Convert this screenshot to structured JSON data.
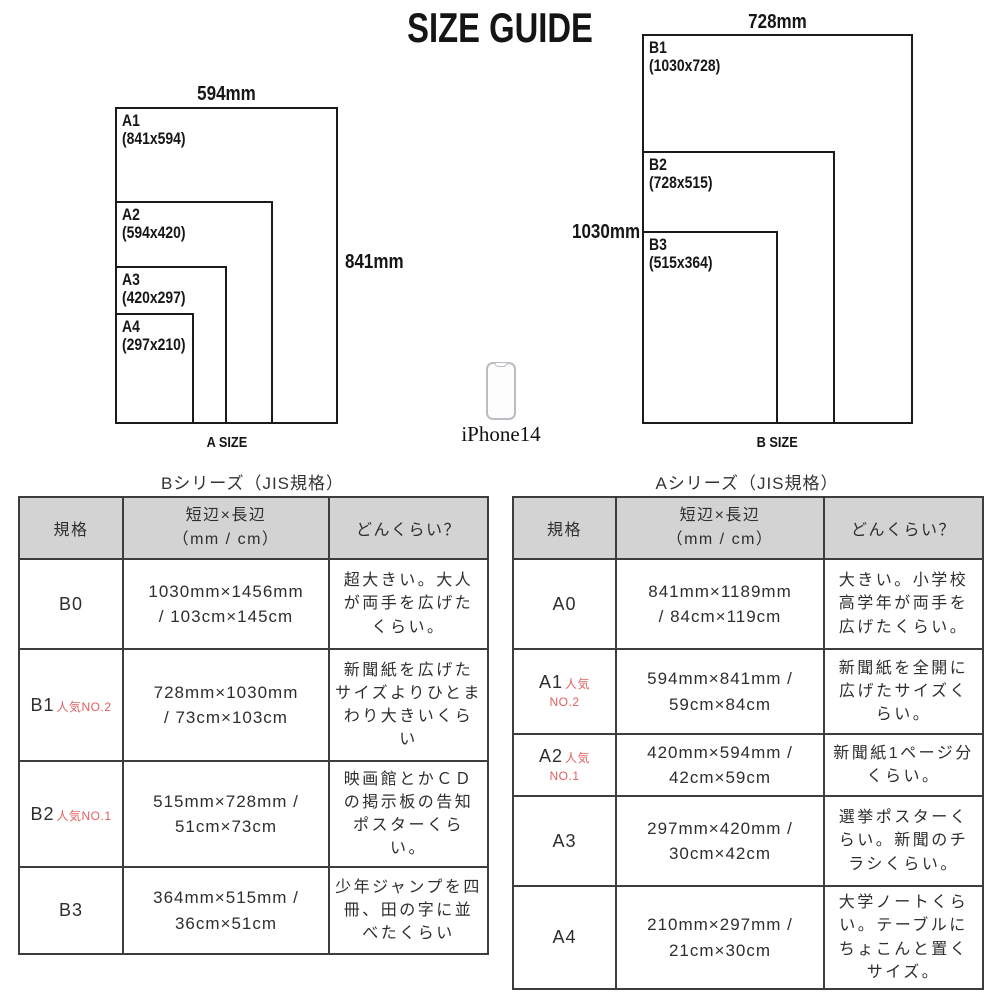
{
  "title": "SIZE GUIDE",
  "diagrams": {
    "a": {
      "caption": "A SIZE",
      "top_dimension": "594mm",
      "side_dimension": "841mm",
      "sheets": [
        {
          "name": "A1",
          "dims": "(841x594)"
        },
        {
          "name": "A2",
          "dims": "(594x420)"
        },
        {
          "name": "A3",
          "dims": "(420x297)"
        },
        {
          "name": "A4",
          "dims": "(297x210)"
        }
      ]
    },
    "b": {
      "caption": "B SIZE",
      "top_dimension": "728mm",
      "side_dimension": "1030mm",
      "sheets": [
        {
          "name": "B1",
          "dims": "(1030x728)"
        },
        {
          "name": "B2",
          "dims": "(728x515)"
        },
        {
          "name": "B3",
          "dims": "(515x364)"
        }
      ]
    }
  },
  "phone": {
    "label": "iPhone14"
  },
  "tables": {
    "b": {
      "title": "Bシリーズ（JIS規格）",
      "headers": {
        "size": "規格",
        "dimension_line1": "短辺×長辺",
        "dimension_line2": "（mm / cm）",
        "description": "どんくらい？"
      },
      "rows": [
        {
          "size": "B0",
          "badge": "",
          "badge2": "",
          "dim1": "1030mm×1456mm",
          "dim2": "/ 103cm×145cm",
          "dimensions": "1030mm×1456mm / 103cm×145cm",
          "description": "超大きい。大人が両手を広げたくらい。"
        },
        {
          "size": "B1",
          "badge": "人気NO.2",
          "badge2": "",
          "dim1": "728mm×1030mm",
          "dim2": "/ 73cm×103cm",
          "dimensions": "728mm×1030mm / 73cm×103cm",
          "description": "新聞紙を広げたサイズよりひとまわり大きいくらい"
        },
        {
          "size": "B2",
          "badge": "人気NO.1",
          "badge2": "",
          "dim1": "515mm×728mm /",
          "dim2": "51cm×73cm",
          "dimensions": "515mm×728mm / 51cm×73cm",
          "description": "映画館とかＣＤの掲示板の告知ポスターくらい。"
        },
        {
          "size": "B3",
          "badge": "",
          "badge2": "",
          "dim1": "364mm×515mm /",
          "dim2": "36cm×51cm",
          "dimensions": "364mm×515mm / 36cm×51cm",
          "description": "少年ジャンプを四冊、田の字に並べたくらい"
        }
      ]
    },
    "a": {
      "title": "Aシリーズ（JIS規格）",
      "headers": {
        "size": "規格",
        "dimension_line1": "短辺×長辺",
        "dimension_line2": "（mm / cm）",
        "description": "どんくらい？"
      },
      "rows": [
        {
          "size": "A0",
          "badge": "",
          "badge2": "",
          "dim1": "841mm×1189mm",
          "dim2": "/ 84cm×119cm",
          "dimensions": "841mm×1189mm / 84cm×119cm",
          "description": "大きい。小学校高学年が両手を広げたくらい。"
        },
        {
          "size": "A1",
          "badge": "人気",
          "badge2": "NO.2",
          "dim1": "594mm×841mm /",
          "dim2": "59cm×84cm",
          "dimensions": "594mm×841mm / 59cm×84cm",
          "description": "新聞紙を全開に広げたサイズくらい。"
        },
        {
          "size": "A2",
          "badge": "人気",
          "badge2": "NO.1",
          "dim1": "420mm×594mm /",
          "dim2": "42cm×59cm",
          "dimensions": "420mm×594mm / 42cm×59cm",
          "description": "新聞紙1ページ分くらい。"
        },
        {
          "size": "A3",
          "badge": "",
          "badge2": "",
          "dim1": "297mm×420mm /",
          "dim2": "30cm×42cm",
          "dimensions": "297mm×420mm / 30cm×42cm",
          "description": "選挙ポスターくらい。新聞のチラシくらい。"
        },
        {
          "size": "A4",
          "badge": "",
          "badge2": "",
          "dim1": "210mm×297mm /",
          "dim2": "21cm×30cm",
          "dimensions": "210mm×297mm / 21cm×30cm",
          "description": "大学ノートくらい。テーブルにちょこんと置くサイズ。"
        }
      ]
    }
  },
  "colors": {
    "accent_red": "#e06060",
    "header_bg": "#d3d3d3",
    "table_border": "#3d3d3d",
    "diagram_line": "#1b1b1b",
    "phone_outline": "#b9bdc1"
  }
}
